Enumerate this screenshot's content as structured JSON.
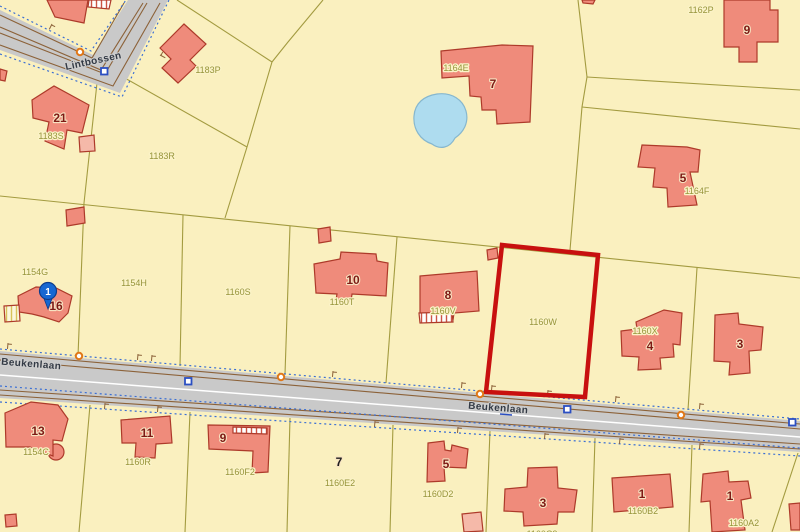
{
  "map": {
    "roads": {
      "lintbossen": "Lintbossen",
      "beukenlaan_west": "Beukenlaan",
      "beukenlaan_east": "Beukenlaan"
    },
    "parcels": {
      "p1183P": "1183P",
      "p1183S": "1183S",
      "p1183R": "1183R",
      "p1154G": "1154G",
      "p1154H": "1154H",
      "p1154C": "1154C",
      "p1160S": "1160S",
      "p1160T": "1160T",
      "p1160V": "1160V",
      "p1160W": "1160W",
      "p1160X": "1160X",
      "p1164E": "1164E",
      "p1164F": "1164F",
      "p1162P": "1162P",
      "p1160R": "1160R",
      "p1160F2": "1160F2",
      "p1160E2": "1160E2",
      "p1160D2": "1160D2",
      "p1160C2": "1160C2",
      "p1160B2": "1160B2",
      "p1160A2": "1160A2"
    },
    "numbers": {
      "n21": "21",
      "n16": "16",
      "n10": "10",
      "n8": "8",
      "n7_top": "7",
      "n9_top": "9",
      "n5_top": "5",
      "n4": "4",
      "n3_east": "3",
      "n13": "13",
      "n11": "11",
      "n9_bottom": "9",
      "n7_bottom": "7",
      "n5_bottom": "5",
      "n3_bottom": "3",
      "n1_west": "1",
      "n1_east": "1"
    },
    "marker": {
      "label": "1"
    },
    "highlight": {
      "selected_parcel": "1160W",
      "color": "#C8100F"
    },
    "colors": {
      "background": "#FAF0BF",
      "building_fill": "#EF8B7B",
      "building_fill_light": "#F5B9A9",
      "building_stroke": "#AD3A2A",
      "road_fill": "#C9C9C9",
      "road_edge_brown": "#8C6239",
      "boundary_olive": "#A39B40",
      "water_fill": "#AEDCEF",
      "water_stroke": "#86B7CE",
      "dotted_blue": "#3B6FD4",
      "marker_blue": "#1767D2",
      "marker_orange": "#E07818"
    }
  }
}
